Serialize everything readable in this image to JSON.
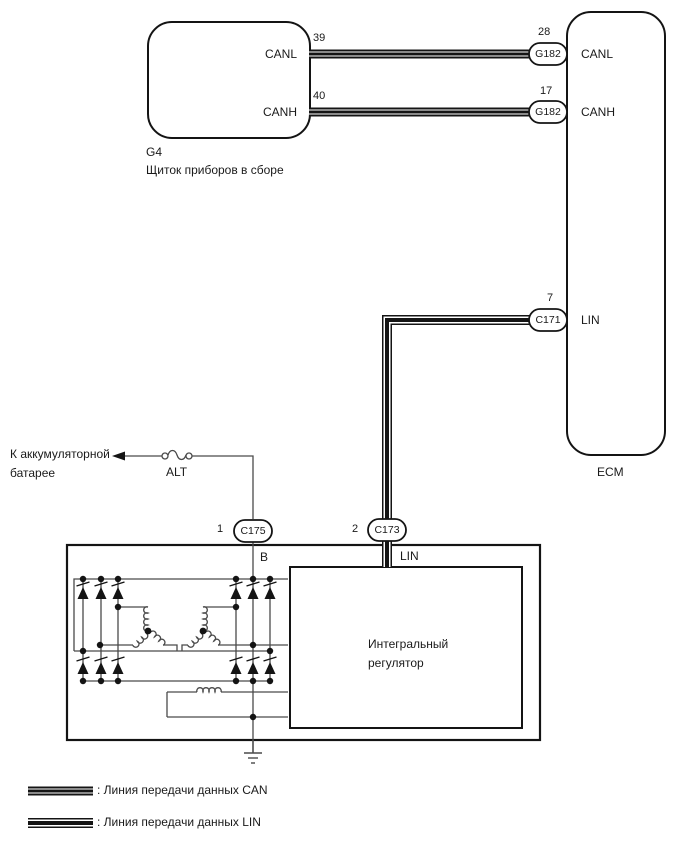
{
  "instrument_cluster": {
    "code": "G4",
    "title": "Щиток приборов в сборе",
    "label_canl": "CANL",
    "label_canh": "CANH",
    "pin_canl": "39",
    "pin_canh": "40"
  },
  "ecm": {
    "title": "ECM",
    "label_canl": "CANL",
    "label_canh": "CANH",
    "label_lin": "LIN",
    "pin_canl": "28",
    "pin_canh": "17",
    "pin_lin": "7"
  },
  "connectors": {
    "canl": "G182",
    "canh": "G182",
    "lin_ecm": "C171",
    "alt_b": "C175",
    "alt_lin": "C173",
    "pin_b": "1",
    "pin_lin": "2"
  },
  "battery_feed": {
    "label_line1": "К аккумуляторной",
    "label_line2": "батарее",
    "fuse": "ALT"
  },
  "alternator": {
    "terminal_b": "B",
    "terminal_lin": "LIN",
    "regulator_line1": "Интегральный",
    "regulator_line2": "регулятор"
  },
  "legend": {
    "can": ": Линия передачи данных CAN",
    "lin": ": Линия передачи данных LIN"
  },
  "colors": {
    "line": "#1a1a1a",
    "thin_line": "#4a4a4a",
    "background": "#ffffff"
  }
}
